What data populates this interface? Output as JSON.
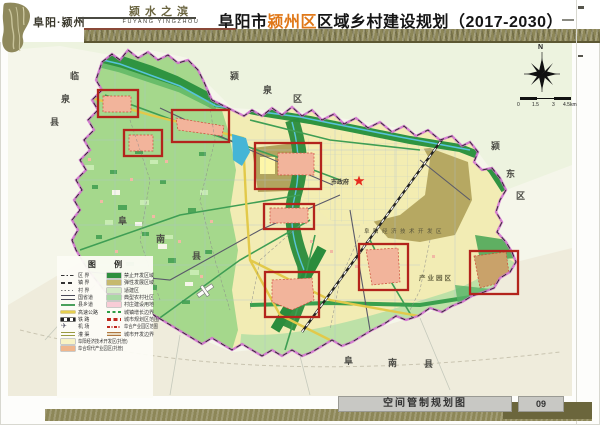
{
  "header": {
    "brand": "阜阳·颍州",
    "motto": "颍水之滨",
    "motto_en": "FUYANG YINGZHOU",
    "title_prefix": "阜阳市",
    "title_highlight": "颍州区",
    "title_suffix": "区域乡村建设规划（2017-2030）",
    "highlight_color": "#e07818"
  },
  "map": {
    "compass": "N",
    "scale_labels": [
      "0",
      "1.5",
      "3",
      "4.5km"
    ],
    "neighbor_labels": {
      "west": "临泉县",
      "north": "颍泉区",
      "east": "颍东区",
      "southwest": "阜南县",
      "south": "阜南县"
    },
    "poi": {
      "city_gov": "市政府",
      "dev_zone": "阜阳经济技术开发区",
      "industrial_park": "产业园区"
    },
    "highlight_color": "#b3241c",
    "boundary_color": "#cf6bcf"
  },
  "legend": {
    "title": "图 例",
    "left_items": [
      {
        "label": "区 界",
        "swatch": "dashdot"
      },
      {
        "label": "镇 界",
        "swatch": "dash"
      },
      {
        "label": "村 界",
        "swatch": "dot"
      },
      {
        "label": "国省道",
        "swatch": "road-dark"
      },
      {
        "label": "县乡道",
        "swatch": "road-green"
      },
      {
        "label": "高速公路",
        "swatch": "road-yellow"
      },
      {
        "label": "铁 路",
        "swatch": "rail"
      },
      {
        "label": "机 场",
        "swatch": "airport"
      },
      {
        "label": "灌 渠",
        "swatch": "canal"
      },
      {
        "label": "阜阳经济技术开发区(托管)",
        "swatch": "#f8f3c4"
      },
      {
        "label": "阜合现代产业园区(托管)",
        "swatch": "#f0b68c"
      }
    ],
    "right_items": [
      {
        "label": "禁止开发区域",
        "swatch": "#2e8f3e"
      },
      {
        "label": "弹性发展区域",
        "swatch": "#c6b96e"
      },
      {
        "label": "适建区",
        "swatch": "#d2eac4"
      },
      {
        "label": "典型农村社区",
        "swatch": "#a9daa4"
      },
      {
        "label": "村庄建设用地",
        "swatch": "#f8ccd6"
      },
      {
        "label": "城镇增长边界",
        "swatch": "bound-green"
      },
      {
        "label": "城市规划区范围",
        "swatch": "bound-red"
      },
      {
        "label": "阜合产业园区范围",
        "swatch": "bound-red-dot"
      },
      {
        "label": "城市开发边界",
        "swatch": "bound-tan"
      }
    ]
  },
  "footer": {
    "caption": "空间管制规划图",
    "page_no": "09"
  }
}
